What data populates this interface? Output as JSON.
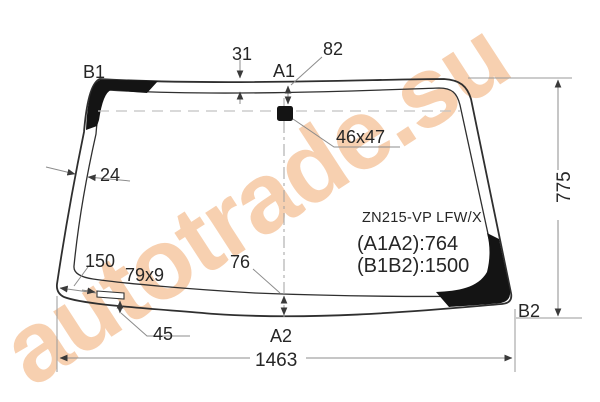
{
  "diagram": {
    "watermark": "autotrade.su",
    "glass": {
      "part_code": "ZN215-VP  LFW/X",
      "dim_a1a2": "(A1A2):764",
      "dim_b1b2": "(B1B2):1500"
    },
    "corner_labels": {
      "b1": "B1",
      "a1": "A1",
      "a2": "A2",
      "b2": "B2"
    },
    "dimensions": {
      "top_band": "31",
      "mirror_offset": "82",
      "mirror_pad_size": "46x47",
      "side_band": "24",
      "bottom_left_offset": "150",
      "button_size": "79x9",
      "bottom_band": "76",
      "button_edge_gap": "45",
      "height": "775",
      "width": "1463"
    },
    "colors": {
      "watermark": "#f7d0b0",
      "outline": "#2f2f2f",
      "dimension_line": "#8c8c8c",
      "frit_black": "#141414"
    }
  }
}
